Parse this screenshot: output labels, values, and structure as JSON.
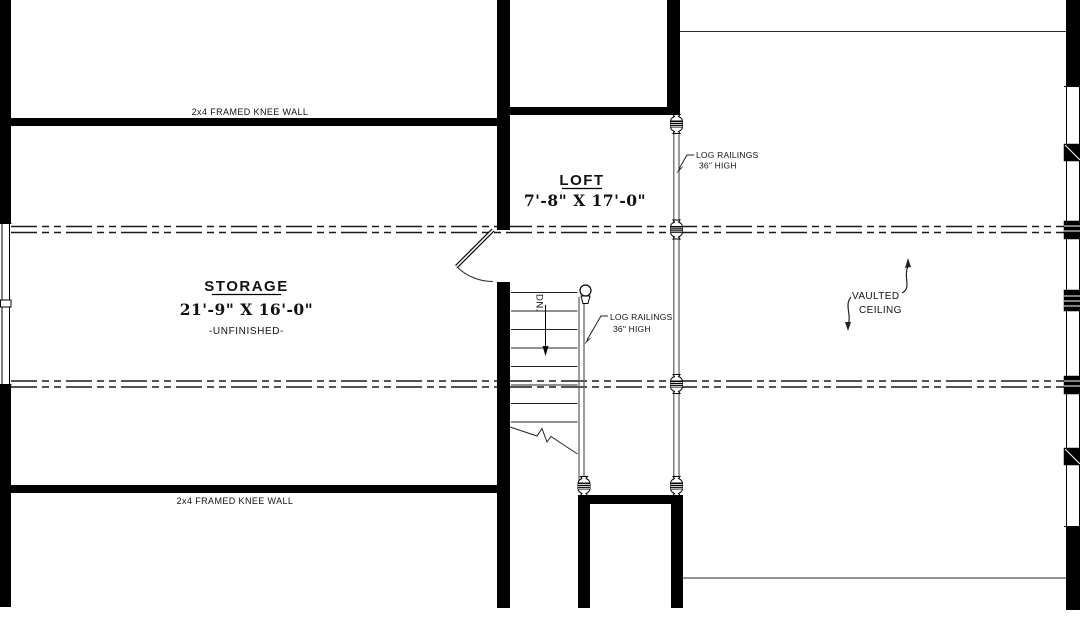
{
  "plan": {
    "rooms": {
      "storage": {
        "name": "STORAGE",
        "dimensions": "21'-9\" X 16'-0\"",
        "status": "-UNFINISHED-"
      },
      "loft": {
        "name": "LOFT",
        "dimensions": "7'-8\" X 17'-0\""
      }
    },
    "annotations": {
      "knee_wall_top": "2x4 FRAMED KNEE WALL",
      "knee_wall_bottom": "2x4 FRAMED KNEE WALL",
      "log_railing_loft_line1": "LOG RAILINGS",
      "log_railing_loft_line2": "36\" HIGH",
      "log_railing_stair_line1": "LOG RAILINGS",
      "log_railing_stair_line2": "36\" HIGH",
      "vaulted_line1": "VAULTED",
      "vaulted_line2": "CEILING",
      "stair_direction": "DN."
    },
    "colors": {
      "wall": "#000000",
      "background": "#ffffff",
      "railing": "#5a5a5a",
      "centerline": "#1a1a1a"
    }
  }
}
